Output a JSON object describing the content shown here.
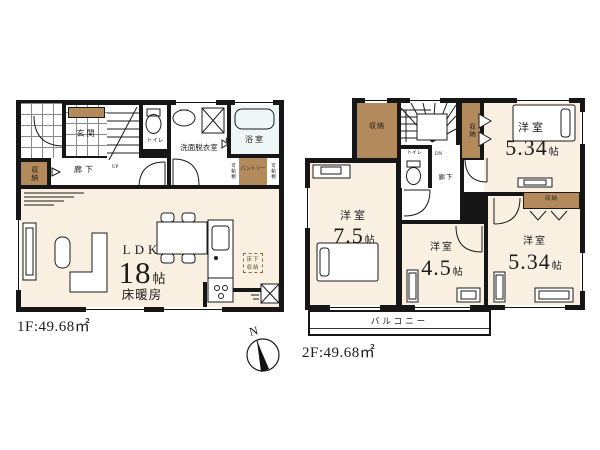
{
  "floor1": {
    "area_label": "1F:49.68㎡",
    "stairs_label": "UP",
    "rooms": {
      "genkan": "玄関",
      "toilet": "トイレ",
      "washroom": "洗面脱衣室",
      "bath": "浴室",
      "storage": "収納",
      "hallway": "廊下",
      "pantry": "パントリー",
      "shelf": "可動棚",
      "underfloor_line1": "床下",
      "underfloor_line2": "収納",
      "ldk": {
        "name": "LDK",
        "size_num": "18",
        "size_unit": "帖",
        "note": "床暖房"
      }
    }
  },
  "floor2": {
    "area_label": "2F:49.68㎡",
    "stairs_label": "DN",
    "rooms": {
      "storage_nw": "収納",
      "storage_mid": "収納",
      "toilet": "トイレ",
      "hallway": "廊下",
      "closet": "収納",
      "balcony": "バルコニー",
      "room_ne": {
        "name": "洋室",
        "size_num": "5.34",
        "size_unit": "帖"
      },
      "room_w": {
        "name": "洋室",
        "size_num": "7.5",
        "size_unit": "帖"
      },
      "room_s": {
        "name": "洋室",
        "size_num": "4.5",
        "size_unit": "帖"
      },
      "room_se": {
        "name": "洋室",
        "size_num": "5.34",
        "size_unit": "帖"
      }
    }
  },
  "compass": {
    "north_label": "N"
  },
  "colors": {
    "wall": "#161616",
    "floor": "#faf0e2",
    "closet": "#b28a5c",
    "bath": "#eef7f6"
  }
}
